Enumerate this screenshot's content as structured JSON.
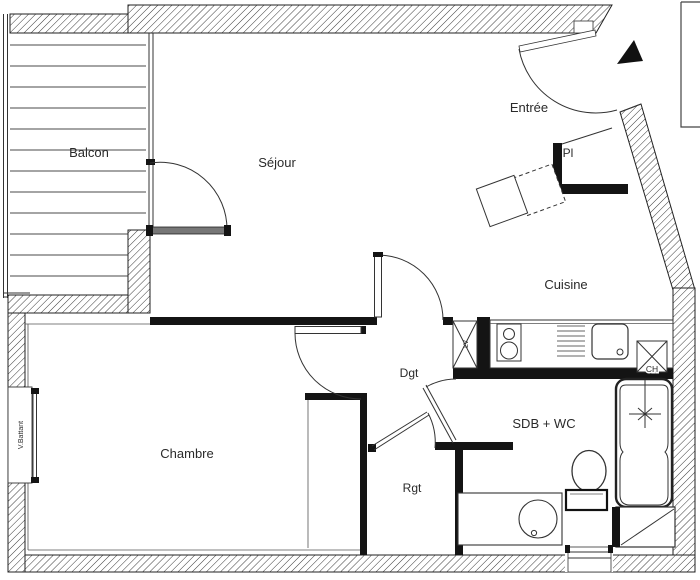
{
  "plan": {
    "rooms": {
      "balcon": "Balcon",
      "sejour": "Séjour",
      "entree": "Entrée",
      "pl": "Pl",
      "cuisine": "Cuisine",
      "dgt": "Dgt",
      "chambre": "Chambre",
      "rgt": "Rgt",
      "sdb": "SDB + WC"
    },
    "annotations": {
      "window_left": "V.Battant",
      "water_heater": "CH",
      "appliance_box": "LV"
    },
    "colors": {
      "ink": "#1c1c1c",
      "wall_fill": "#141414",
      "door_leaf": "#777777",
      "background": "#ffffff"
    }
  }
}
